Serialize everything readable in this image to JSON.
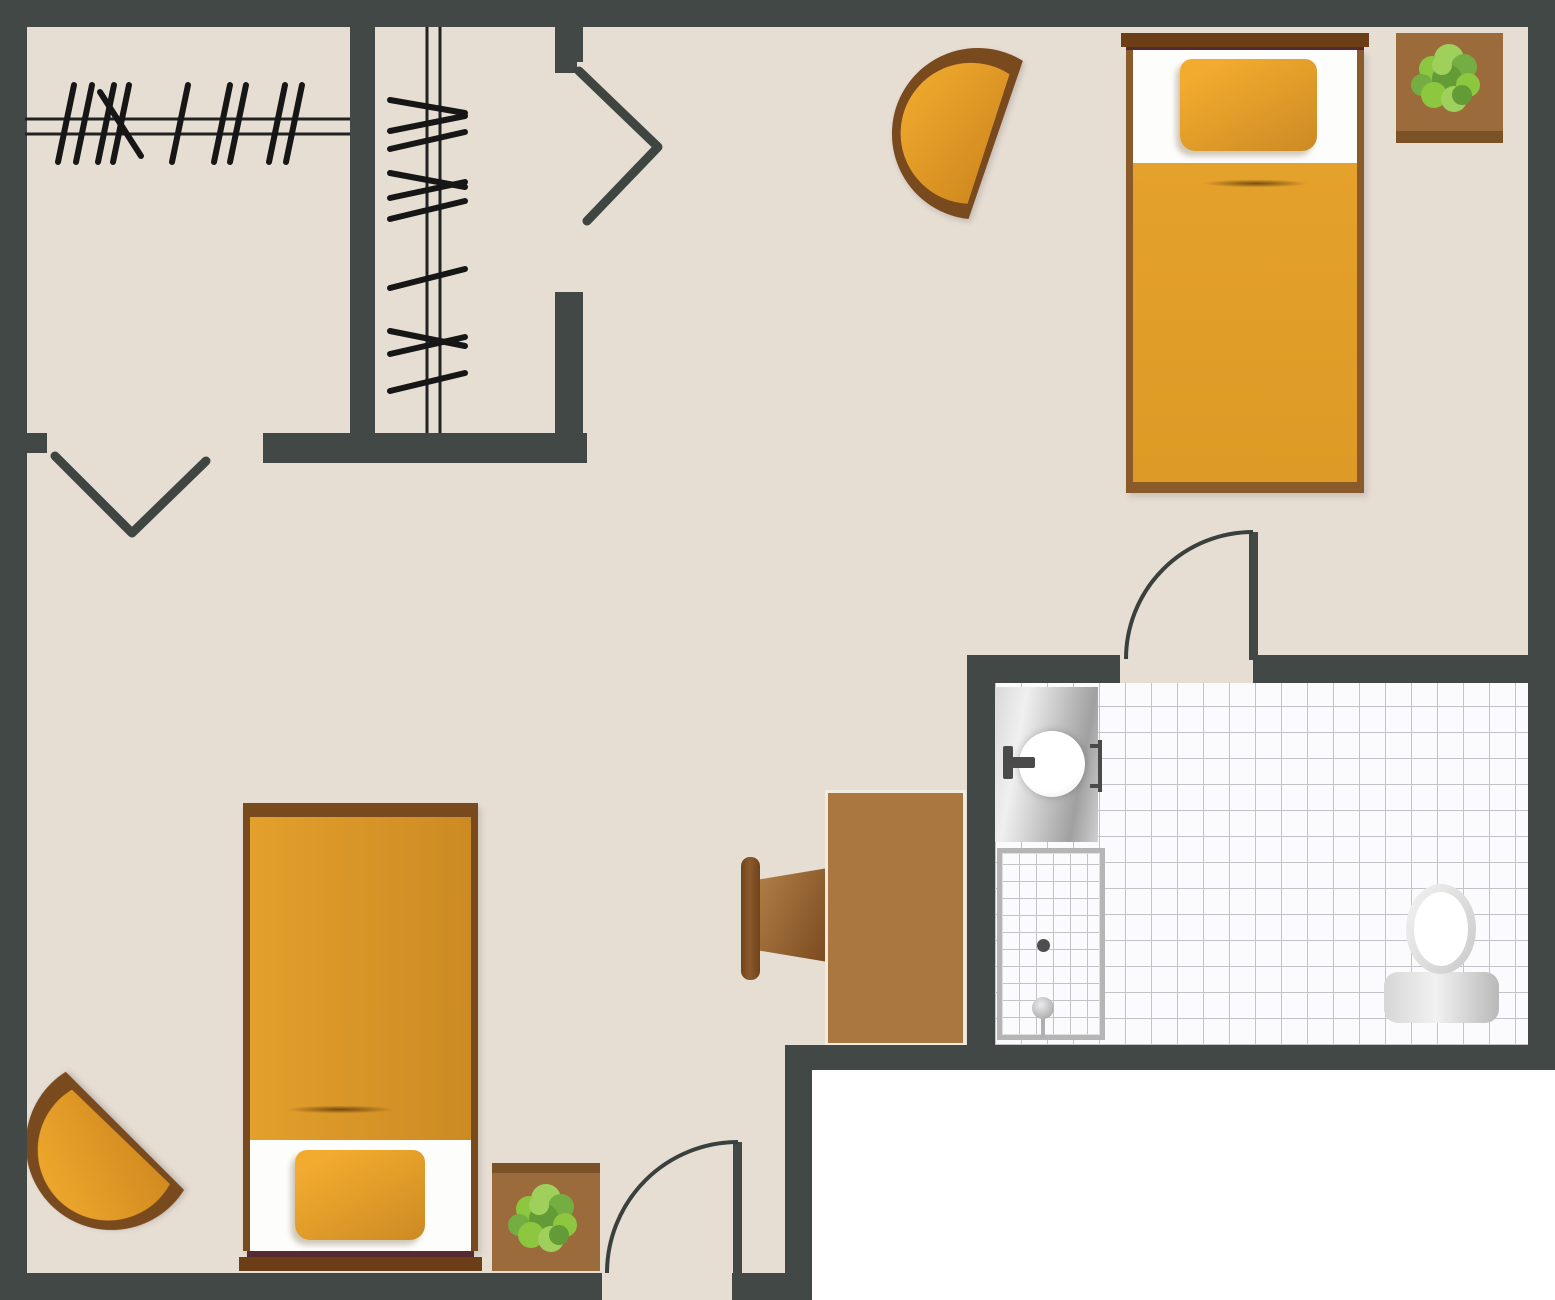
{
  "app": {
    "title": "",
    "type": "floor-plan"
  },
  "palette": {
    "floor": "#e6ddd3",
    "wall": "#414845",
    "outside": "#ffffff",
    "door-line": "#3a403d",
    "symbol-line": "#3f4642",
    "rod-line": "#222222",
    "hanger-line": "#161616",
    "wood": "#8a5a2b",
    "wood-dark": "#7a4a1f",
    "headboard": "#6b3e17",
    "headboard-trim": "#552a31",
    "orange": "#e4a12b",
    "orange-deep": "#cc8a24",
    "orange-light": "#f2ab2e",
    "desk-wood": "#a9773f",
    "pot": "#9c6b3c",
    "pot-trim": "#7b5226",
    "leaf-light": "#9fd05c",
    "leaf-mid": "#8dc63f",
    "leaf-mid2": "#74ad41",
    "leaf-dark": "#639c36",
    "tile-bg": "#fbfbfd",
    "tile-line": "#c2c2c8",
    "fixture-light": "#f0f0f0",
    "fixture-mid": "#c9c9c9",
    "fixture-dark": "#a0a0a0",
    "faucet": "#4a4a4a"
  },
  "floor_plan": {
    "rooms": [
      {
        "name": "closet-left",
        "features": [
          "clothes-rod-horizontal",
          "hangers"
        ]
      },
      {
        "name": "closet-right",
        "features": [
          "clothes-rod-vertical",
          "hangers"
        ]
      },
      {
        "name": "bedroom-nook-top-right",
        "furniture": [
          "single-bed",
          "tub-chair",
          "potted-plant"
        ]
      },
      {
        "name": "main-room",
        "furniture": [
          "single-bed",
          "tub-chair",
          "potted-plant",
          "desk",
          "desk-chair"
        ]
      },
      {
        "name": "bathroom",
        "fixtures": [
          "vanity-sink",
          "faucet",
          "shower-stall",
          "shower-head",
          "drain",
          "toilet"
        ]
      }
    ],
    "doors": [
      {
        "name": "entry-door",
        "type": "swing-arc"
      },
      {
        "name": "bathroom-door",
        "type": "swing-arc"
      },
      {
        "name": "closet-door-left",
        "type": "bifold-v"
      },
      {
        "name": "closet-door-right",
        "type": "bifold-chevron"
      }
    ]
  }
}
